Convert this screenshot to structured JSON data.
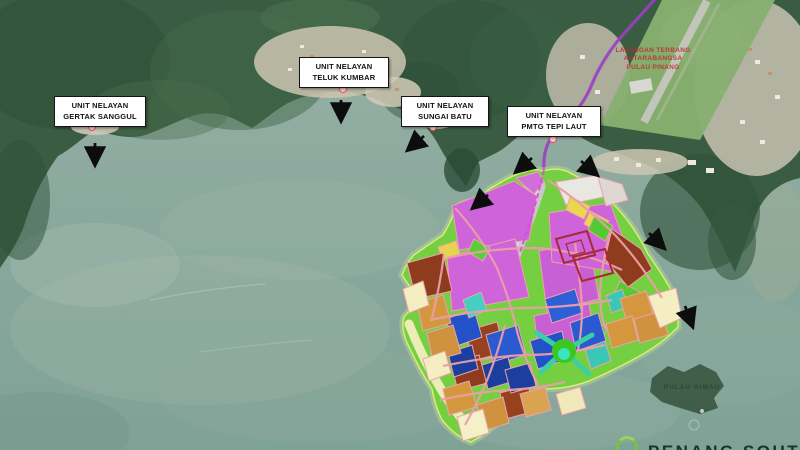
{
  "title": "Penang South masterplan satellite map",
  "labels": {
    "fishing_units": [
      {
        "line1": "UNIT NELAYAN",
        "line2": "GERTAK SANGGUL"
      },
      {
        "line1": "UNIT NELAYAN",
        "line2": "TELUK KUMBAR"
      },
      {
        "line1": "UNIT NELAYAN",
        "line2": "SUNGAI BATU"
      },
      {
        "line1": "UNIT NELAYAN",
        "line2": "PMTG TEPI LAUT"
      }
    ],
    "airport": {
      "line1": "LAPANGAN TERBANG",
      "line2": "ANTARABANGSA",
      "line3": "PULAU PINANG"
    },
    "offshore_island": "PULAU RIMAU",
    "watermark": "PENANG SOUTH"
  },
  "palette": {
    "sea": "#8CA89D",
    "forest": "#3A5C42",
    "urban": "#CDC5B2",
    "island_open_space": "#74CF41",
    "parcel_magenta": "#CE63DA",
    "parcel_blue": "#2351C8",
    "parcel_teal": "#38C8B3",
    "parcel_orange": "#D5973E",
    "parcel_brown": "#8E3B1E",
    "parcel_yellow": "#EBD74D",
    "parcel_cream": "#F4EEC2",
    "road_pink": "#EA9FA8",
    "road_red": "#A62A3C",
    "route_purple": "#9B3FC2",
    "airport_text": "#C0272D",
    "label_border": "#151515",
    "logo_green": "#7AC143"
  }
}
